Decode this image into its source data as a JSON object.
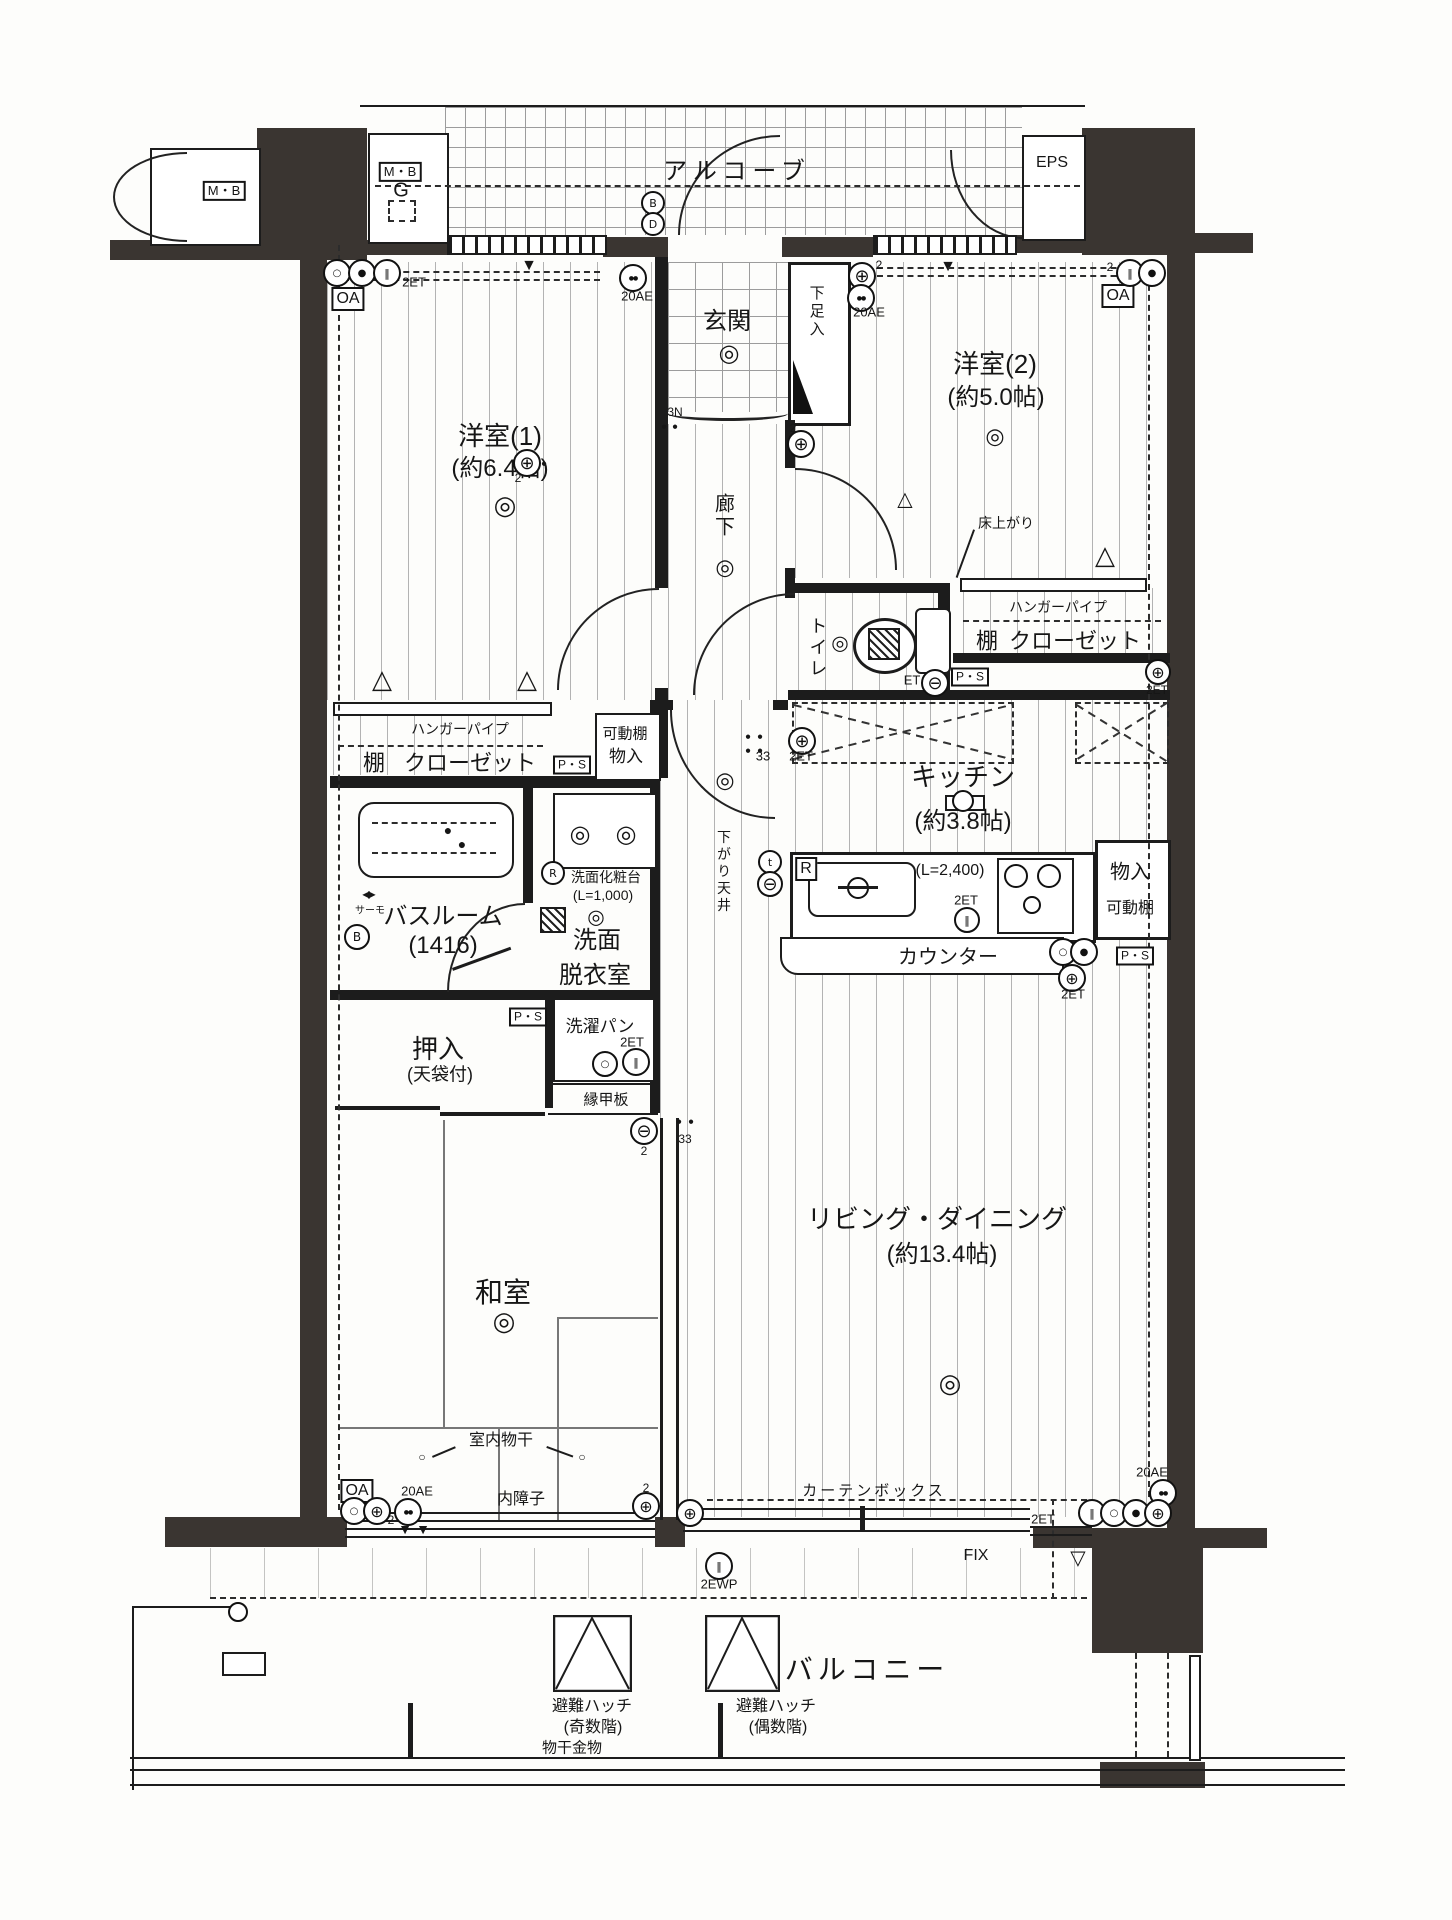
{
  "labels": {
    "alcove": "アルコーブ",
    "mb": "M・B",
    "g": "G",
    "eps": "EPS",
    "genkan": "玄関",
    "shoe_box": "下足入",
    "n3": "3N",
    "western1": "洋室(1)",
    "western1_size": "(約6.4帖)",
    "western2": "洋室(2)",
    "western2_size": "(約5.0帖)",
    "hallway": "廊下",
    "toilet": "トイレ",
    "floor_raised": "床上がり",
    "hanger_pipe": "ハンガーパイプ",
    "shelf": "棚",
    "closet": "クローゼット",
    "movable_shelf": "可動棚",
    "storage": "物入",
    "kitchen": "キッチン",
    "kitchen_size": "(約3.8帖)",
    "counter_length": "(L=2,400)",
    "counter": "カウンター",
    "lowered_ceiling": "下がり天井",
    "bathroom": "バスルーム",
    "bathroom_size": "(1416)",
    "thermo": "サーモ",
    "vanity": "洗面化粧台",
    "vanity_length": "(L=1,000)",
    "washroom1": "洗面",
    "washroom2": "脱衣室",
    "laundry_pan": "洗濯パン",
    "oshiire": "押入",
    "oshiire_note": "(天袋付)",
    "engawa": "縁甲板",
    "japanese_room": "和室",
    "indoor_drying": "室内物干",
    "inner_shoji": "内障子",
    "living": "リビング・ダイニング",
    "living_size": "(約13.4帖)",
    "curtain_box": "カーテンボックス",
    "fix": "FIX",
    "balcony": "バルコニー",
    "hatch": "避難ハッチ",
    "hatch_odd": "(奇数階)",
    "hatch_even": "(偶数階)",
    "drying_hardware": "物干金物",
    "ps": "P・S",
    "oa": "OA",
    "ae20": "20AE",
    "et2": "2ET",
    "et": "ET",
    "ewp2": "2EWP",
    "b": "B",
    "d": "D",
    "r": "R",
    "t": "t",
    "two": "2",
    "g33": "33"
  },
  "icons": {
    "double_circle_icon": "◎",
    "outlet_icon": "⊕",
    "switch_icon": "⊖",
    "bars_icon": "‖",
    "dots_icon": "●●",
    "dot_icon": "●",
    "tri_down_icon": "▼",
    "tri_up_icon": "△",
    "tri_down_outline_icon": "▽",
    "bowtie_icon": "◀▶",
    "circle_icon": "○"
  }
}
